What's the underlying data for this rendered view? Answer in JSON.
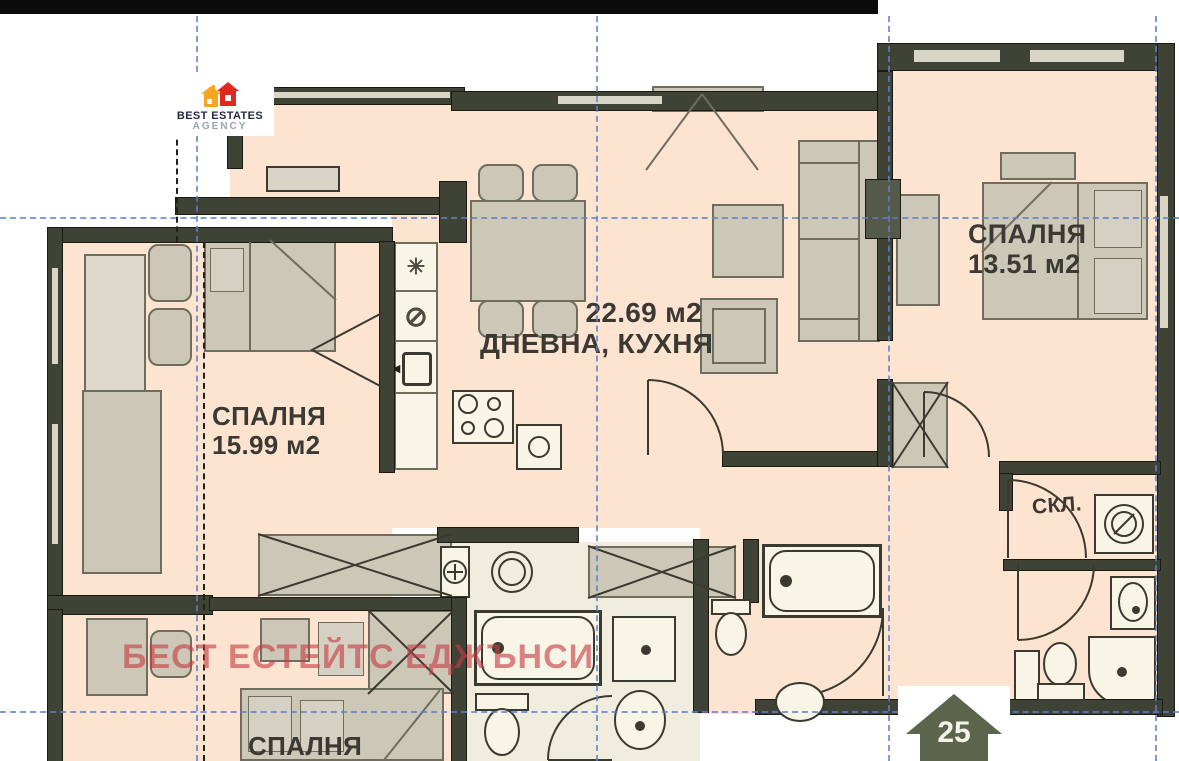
{
  "page": {
    "type": "apartment-floor-plan"
  },
  "logo": {
    "line1": "BEST ESTATES",
    "line2": "AGENCY"
  },
  "watermark": {
    "text": "БЕСТ ЕСТЕЙТС ЕДЖЪНСИ"
  },
  "rooms": {
    "bedroom_top_right": {
      "name": "СПАЛНЯ",
      "area": "13.51 м2"
    },
    "living_kitchen": {
      "area": "22.69 м2",
      "name": "ДНЕВНА, КУХНЯ"
    },
    "bedroom_left": {
      "name": "СПАЛНЯ",
      "area": "15.99 м2"
    },
    "storage": {
      "name": "СКЛ."
    },
    "bedroom_bottom": {
      "name": "СПАЛНЯ"
    }
  },
  "unit_marker": {
    "number": "25"
  },
  "icons": {
    "fridge": "✳",
    "sink_crossed": "⊘",
    "door_unit": "◄"
  },
  "colors": {
    "floor_peach": "#fce4d0",
    "bath_floor": "#f0edde",
    "wall_dark": "#3f4336",
    "furniture_gray": "#cdc7b8",
    "grid_blue": "#5d7fce",
    "watermark_red": "#c63e46",
    "marker_green": "#5a654c",
    "logo_red": "#e02a20",
    "logo_orange": "#f5a623"
  }
}
